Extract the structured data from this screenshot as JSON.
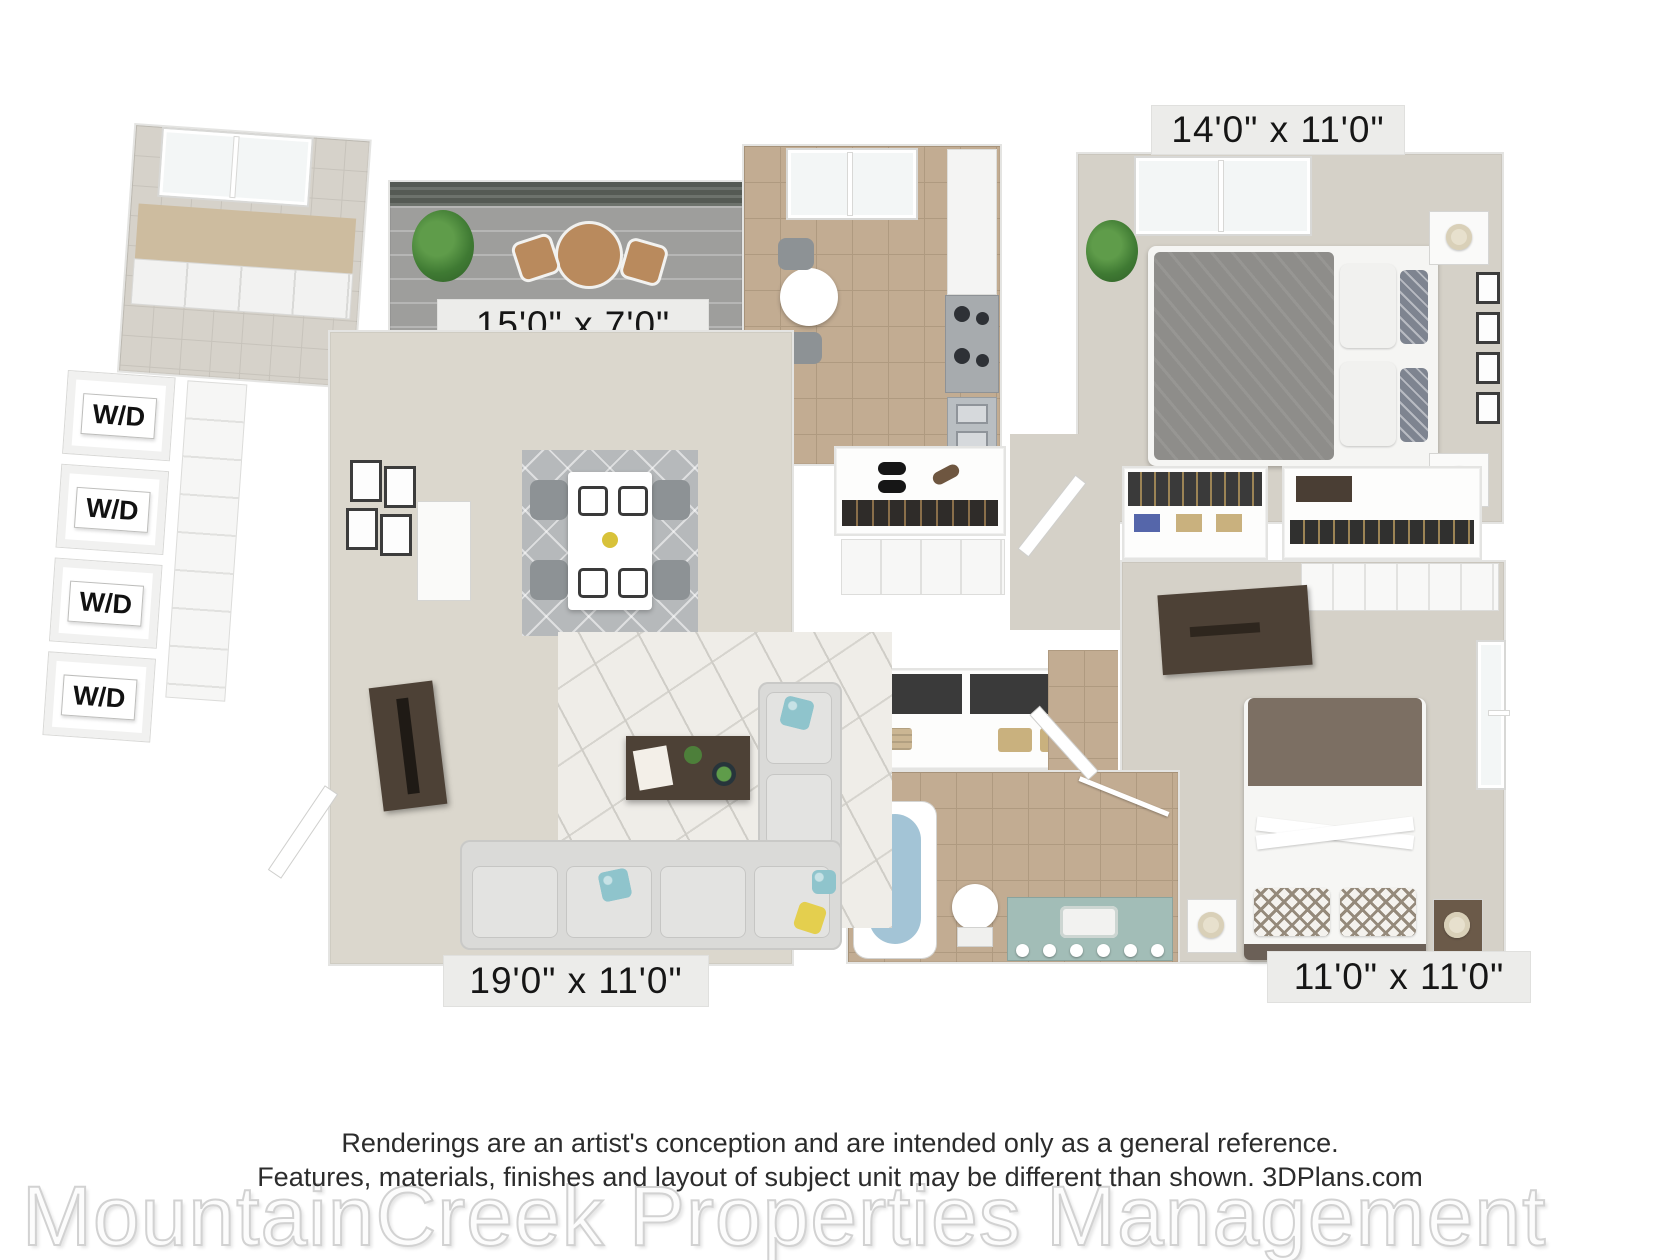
{
  "labels": {
    "master_bedroom": "14'0\" x 11'0\"",
    "patio": "15'0\" x 7'0\"",
    "living_room": "19'0\" x 11'0\"",
    "second_bedroom": "11'0\" x 11'0\""
  },
  "laundry": {
    "wd": [
      "W/D",
      "W/D",
      "W/D",
      "W/D"
    ]
  },
  "footer": {
    "line1": "Renderings are an artist's conception and are intended only as a general reference.",
    "line2": "Features, materials, finishes and layout of subject unit may be different than shown. 3DPlans.com",
    "watermark": "MountainCreek Properties Management"
  },
  "colors": {
    "kitchen_tile": "#c2ac92",
    "carpet": "#dbd7cd",
    "patio_concrete": "#9e9e9c",
    "tub_blue": "#a3c4d6",
    "vanity_teal": "#a2bdb7",
    "dark_wood": "#4d4136",
    "sofa_gray": "#dadad8",
    "duvet_gray": "#8e8d8a"
  }
}
